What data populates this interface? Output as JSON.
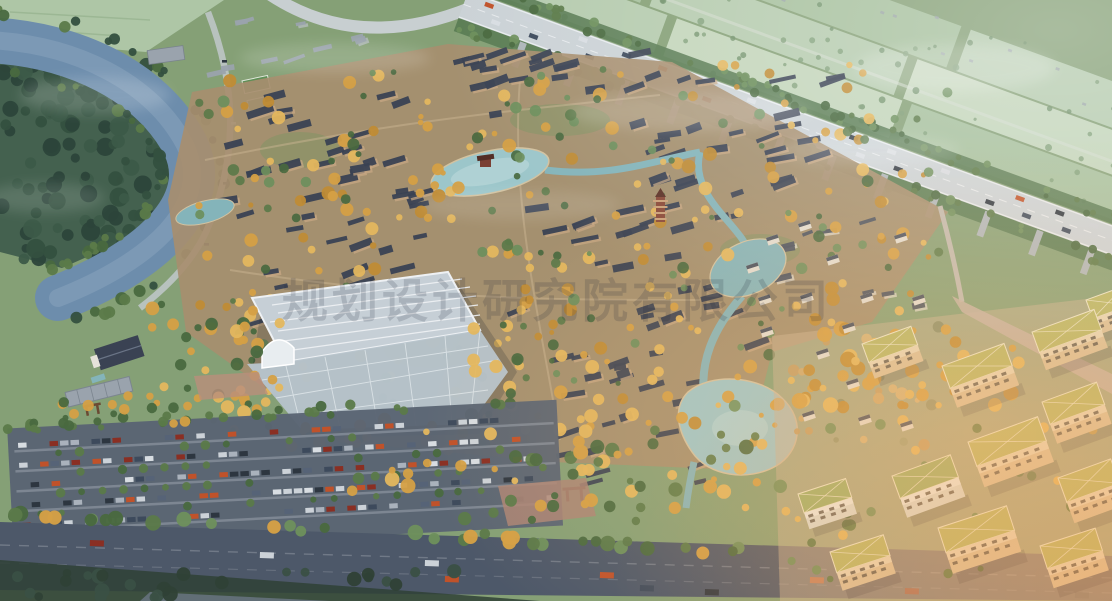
{
  "meta": {
    "title": "Aerial masterplan rendering",
    "description": "Bird's-eye architectural rendering at sunset: a traditional Chinese courtyard-house village with golden autumn trees, central lake with pavilion, a pagoda, a large white-framed greenhouse, ponds and streams; bounded by a curving river with forested banks (top-left), an elevated expressway over pale farmland (top-right), tree-lined parking lots and a wide avenue (bottom), and a modern mid-rise campus with olive-green trussed roofs in warm light (bottom-right).",
    "time_of_day": "sunset",
    "view": "aerial oblique"
  },
  "watermark": {
    "text": "规划设计研究院有限公司"
  },
  "palette": {
    "base": "#85a076",
    "field": "#b5cbae",
    "fieldAlt1": "#c3d5ba",
    "fieldAlt2": "#a6c09d",
    "fieldLine": "#8fae88",
    "fieldCorner": "#aec6a6",
    "forest": "#44614f",
    "forestTree": "#34503f",
    "river": "#6d8dac",
    "riverLight": "#8fa9c2",
    "roadLight": "#cbd2d6",
    "roadEdge": "#e9edef",
    "pier": "#aeb6ba",
    "bankRoad": "#b8c2be",
    "villageGround": "#a78e6f",
    "villageGreen": "#7d9464",
    "pathTan": "#c9b491",
    "roof": "#3a4253",
    "roofLight": "#9aa3ad",
    "wall": "#c9a884",
    "villaWall": "#e2ddd2",
    "gold1": "#d5a045",
    "gold2": "#e4b75e",
    "gold3": "#c08c35",
    "green1": "#5b7a49",
    "green2": "#49693f",
    "green3": "#6d8f5c",
    "teal": "#84b4ba",
    "tealLight": "#9cc6ca",
    "shore": "#d2c2a0",
    "ghGlass": "#c6cfd6",
    "ghGlassLow": "#b7c4cc",
    "ghFrame": "#eef1f4",
    "plaza": "#b98f7c",
    "plaza2": "#ac8576",
    "asphalt": "#5a6472",
    "aisle": "#8b94a0",
    "avenue": "#4d5869",
    "campusGround": "#c9b294",
    "campusWall": "#e9dcc0",
    "campusFacade": "#d9c29c",
    "campusRoof": "#b7b868",
    "campusRoofLine": "#ece7cb",
    "windowDark": "#55524a",
    "whiteWall": "#eef0ea",
    "greenRoof": "#9ab06a",
    "pinkRoad": "#c7b3a4",
    "pagoda": "#8a4a3a",
    "gate": "#6b4a33",
    "glowWarm": "#ffc27d",
    "glowDeep": "#ff9a45",
    "mist": "#ffffff",
    "darkTrees": "#2f4136"
  },
  "vehicles": {
    "colors": [
      "#2d3640",
      "#ccd2d8",
      "#8a2f23",
      "#3d4a5c",
      "#d8dde2",
      "#c0522a"
    ]
  },
  "regions": [
    {
      "name": "river-bend",
      "desc": "wide blue-grey river curving around a forested bank, road along outer shore"
    },
    {
      "name": "farmland",
      "desc": "pale hazy field strips with hedgerows beyond the expressway"
    },
    {
      "name": "expressway",
      "desc": "elevated highway viaduct running diagonally with traffic"
    },
    {
      "name": "ramp-loop",
      "desc": "curved interchange ramp at top centre"
    },
    {
      "name": "village",
      "desc": "dense grid of grey-roofed courtyard houses with golden trees"
    },
    {
      "name": "central-lake",
      "desc": "lake with island pavilion at village centre"
    },
    {
      "name": "pagoda",
      "desc": "slender brick pagoda tower east of centre"
    },
    {
      "name": "greenhouse",
      "desc": "large white steel-lattice greenhouse with arched entrance"
    },
    {
      "name": "ponds-streams",
      "desc": "teal ponds and winding streams through the east side"
    },
    {
      "name": "parking",
      "desc": "tree-lined parking rows full of cars, south-west"
    },
    {
      "name": "avenue",
      "desc": "wide dark boulevard with traffic across the bottom"
    },
    {
      "name": "campus",
      "desc": "modern cream mid-rise blocks with olive trussed roofs, sunset light, south-east"
    },
    {
      "name": "villas",
      "desc": "small white courtyard villas among trees near the lakes"
    },
    {
      "name": "watermark",
      "desc": "faint grey CJK company watermark across the middle"
    }
  ]
}
